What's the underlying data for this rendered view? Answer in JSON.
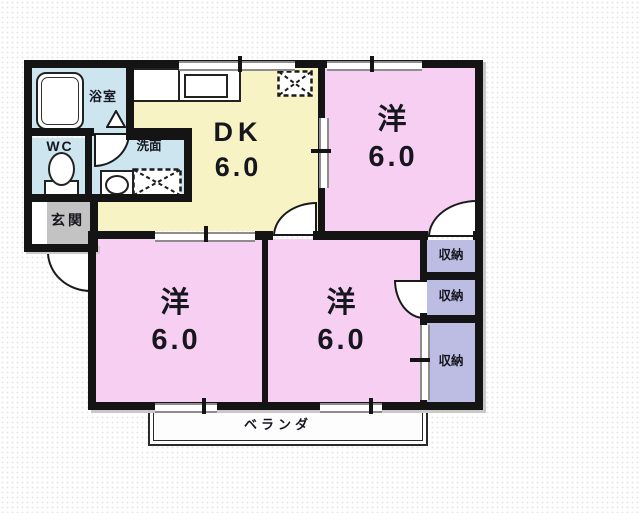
{
  "rooms": {
    "dk": {
      "label": "DK",
      "size": "6.0"
    },
    "western_top_right": {
      "label": "洋",
      "size": "6.0"
    },
    "western_bottom_left": {
      "label": "洋",
      "size": "6.0"
    },
    "western_bottom_right": {
      "label": "洋",
      "size": "6.0"
    },
    "bathroom": {
      "label": "浴室"
    },
    "toilet": {
      "label": "WC"
    },
    "washroom": {
      "label": "洗面"
    },
    "entrance": {
      "label": "玄関"
    },
    "balcony": {
      "label": "ベランダ"
    }
  },
  "closets": [
    {
      "label": "収納"
    },
    {
      "label": "収納"
    },
    {
      "label": "収納"
    }
  ],
  "colors": {
    "western_room": "#f6cff2",
    "dining_kitchen": "#f7f3c4",
    "wet_area": "#cde5ef",
    "closet": "#bdbde4",
    "entrance_floor": "#c3c3c3",
    "wall": "#141414"
  }
}
